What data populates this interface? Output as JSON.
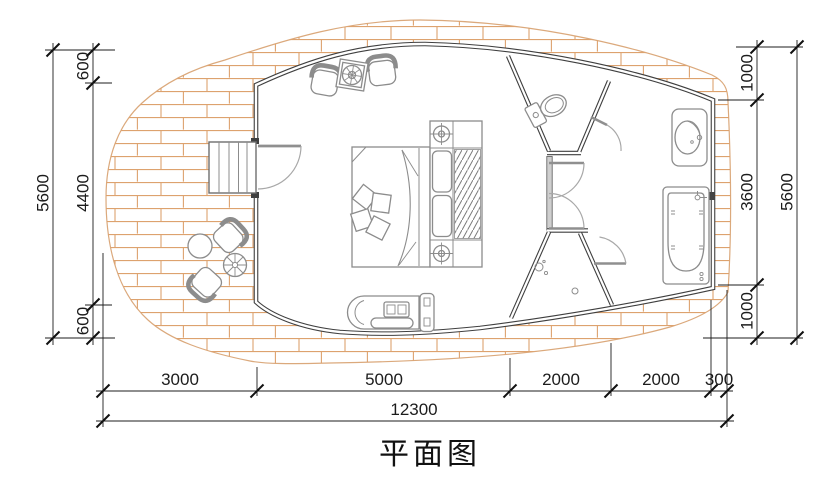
{
  "title": "平面图",
  "colors": {
    "wall": "#3f3f3f",
    "wall_fill": "#cfcfcf",
    "deck_line": "#dda26e",
    "furniture": "#8c8c8c",
    "dimension": "#1c1c1c"
  },
  "dimensions": {
    "left_outer": {
      "total": "5600"
    },
    "left_inner": {
      "segments": [
        "600",
        "4400",
        "600"
      ]
    },
    "right_inner": {
      "segments": [
        "1000",
        "3600",
        "1000"
      ]
    },
    "right_outer": {
      "total": "5600"
    },
    "bottom_primary": {
      "segments": [
        "3000",
        "5000",
        "2000",
        "2000",
        "300"
      ]
    },
    "bottom_overall": {
      "total": "12300"
    }
  }
}
